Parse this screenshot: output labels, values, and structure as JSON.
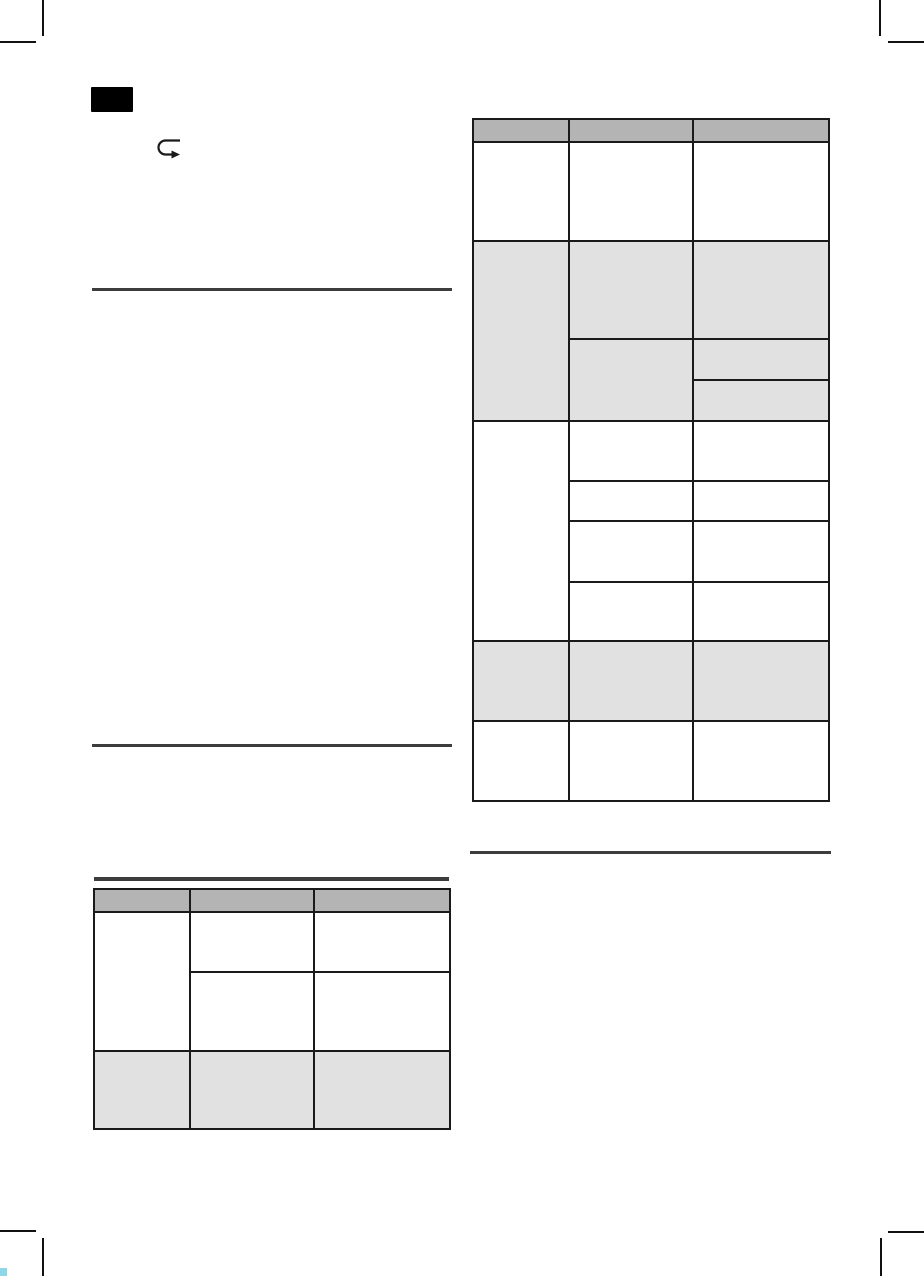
{
  "page": {
    "width": 924,
    "height": 1276,
    "background": "#ffffff",
    "description": "Blank scanned manual page: language tab, return-arrow icon, divider rules, two empty tables with merged cells, corner crop marks"
  },
  "colors": {
    "table_border": "#1a1a1a",
    "header_cell": "#b4b4b4",
    "shaded_cell": "#e1e1e1",
    "white_cell": "#ffffff",
    "divider_rule": "#3d3d3d",
    "crop_mark": "#111111",
    "language_tab": "#000000",
    "registration_mark_cyan": "#8ed7e8",
    "icon_stroke": "#1a1a1a"
  },
  "language_tab": {
    "label": ""
  },
  "icons": {
    "return_arrow": "return-arrow-icon"
  },
  "dividers": [
    {
      "x": 92,
      "y": 288,
      "w": 360,
      "h": 3
    },
    {
      "x": 92,
      "y": 744,
      "w": 360,
      "h": 3
    },
    {
      "x": 94,
      "y": 877,
      "w": 355,
      "h": 4
    },
    {
      "x": 470,
      "y": 851,
      "w": 361,
      "h": 3
    }
  ],
  "crop_marks": [
    {
      "id": "top-left-vertical",
      "x": 42,
      "y": 0,
      "w": 2,
      "h": 36,
      "color": "black"
    },
    {
      "id": "top-left-horizontal",
      "x": 0,
      "y": 41,
      "w": 36,
      "h": 2,
      "color": "black"
    },
    {
      "id": "top-right-vertical",
      "x": 879,
      "y": 0,
      "w": 2,
      "h": 36,
      "color": "black"
    },
    {
      "id": "top-right-horizontal",
      "x": 888,
      "y": 41,
      "w": 36,
      "h": 2,
      "color": "black"
    },
    {
      "id": "bottom-left-horizontal",
      "x": 0,
      "y": 1230,
      "w": 36,
      "h": 2,
      "color": "black"
    },
    {
      "id": "bottom-left-vertical",
      "x": 42,
      "y": 1238,
      "w": 2,
      "h": 38,
      "color": "black"
    },
    {
      "id": "bottom-right-horizontal",
      "x": 888,
      "y": 1231,
      "w": 36,
      "h": 2,
      "color": "black"
    },
    {
      "id": "bottom-right-vertical",
      "x": 880,
      "y": 1238,
      "w": 2,
      "h": 38,
      "color": "black"
    },
    {
      "id": "registration-cyan",
      "x": 0,
      "y": 1268,
      "w": 7,
      "h": 8,
      "color": "cyan"
    }
  ],
  "tables": [
    {
      "name": "right-column-table",
      "x": 472,
      "y": 118,
      "width": 358,
      "height": 684,
      "columns": 3,
      "cells": [
        [
          2,
          2,
          94,
          21,
          "header"
        ],
        [
          98,
          2,
          122,
          21,
          "header"
        ],
        [
          222,
          2,
          134,
          21,
          "header"
        ],
        [
          2,
          25,
          94,
          97,
          "white"
        ],
        [
          98,
          25,
          122,
          97,
          "white"
        ],
        [
          222,
          25,
          134,
          97,
          "white"
        ],
        [
          2,
          124,
          94,
          178,
          "gray"
        ],
        [
          98,
          124,
          122,
          96,
          "gray"
        ],
        [
          222,
          124,
          134,
          96,
          "gray"
        ],
        [
          98,
          222,
          122,
          80,
          "gray"
        ],
        [
          222,
          222,
          134,
          39,
          "gray"
        ],
        [
          222,
          263,
          134,
          39,
          "gray"
        ],
        [
          2,
          304,
          94,
          218,
          "white"
        ],
        [
          98,
          304,
          122,
          58,
          "white"
        ],
        [
          222,
          304,
          134,
          58,
          "white"
        ],
        [
          98,
          364,
          122,
          38,
          "white"
        ],
        [
          222,
          364,
          134,
          38,
          "white"
        ],
        [
          98,
          404,
          122,
          59,
          "white"
        ],
        [
          222,
          404,
          134,
          59,
          "white"
        ],
        [
          98,
          465,
          122,
          57,
          "white"
        ],
        [
          222,
          465,
          134,
          57,
          "white"
        ],
        [
          2,
          524,
          94,
          78,
          "gray"
        ],
        [
          98,
          524,
          122,
          78,
          "gray"
        ],
        [
          222,
          524,
          134,
          78,
          "gray"
        ],
        [
          2,
          604,
          94,
          78,
          "white"
        ],
        [
          98,
          604,
          122,
          78,
          "white"
        ],
        [
          222,
          604,
          134,
          78,
          "white"
        ]
      ]
    },
    {
      "name": "left-column-table",
      "x": 93,
      "y": 888,
      "width": 358,
      "height": 242,
      "columns": 3,
      "cells": [
        [
          2,
          2,
          94,
          21,
          "header"
        ],
        [
          98,
          2,
          122,
          21,
          "header"
        ],
        [
          222,
          2,
          134,
          21,
          "header"
        ],
        [
          2,
          25,
          94,
          137,
          "white"
        ],
        [
          98,
          25,
          122,
          58,
          "white"
        ],
        [
          222,
          25,
          134,
          58,
          "white"
        ],
        [
          98,
          85,
          122,
          77,
          "white"
        ],
        [
          222,
          85,
          134,
          77,
          "white"
        ],
        [
          2,
          164,
          94,
          76,
          "gray"
        ],
        [
          98,
          164,
          122,
          76,
          "gray"
        ],
        [
          222,
          164,
          134,
          76,
          "gray"
        ]
      ]
    }
  ]
}
